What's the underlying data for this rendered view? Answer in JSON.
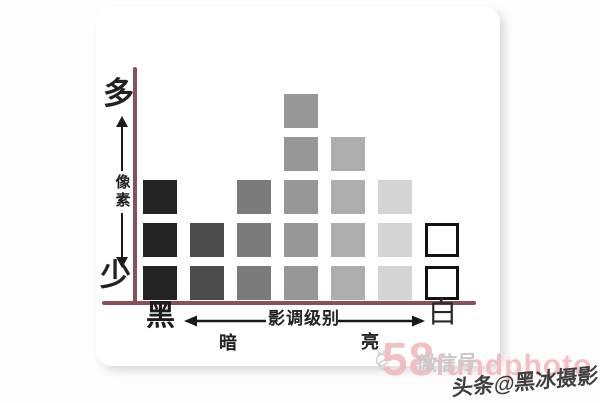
{
  "page": {
    "background": "#fdfdfd",
    "card_background": "#ffffff"
  },
  "axes": {
    "color": "#8b4f5a",
    "arrow_color": "#1a1a1a",
    "y_axis": {
      "top_label": "多",
      "axis_label": "像素",
      "bottom_label": "少"
    },
    "x_axis": {
      "left_label": "黑",
      "center_label": "影调级别",
      "right_label": "白",
      "sub_left_label": "暗",
      "sub_right_label": "亮"
    }
  },
  "chart_data": {
    "type": "bar",
    "x_label": "影调级别",
    "y_label": "像素",
    "x_min_label": "黑",
    "x_max_label": "白",
    "y_min_label": "少",
    "y_max_label": "多",
    "categories": [
      1,
      2,
      3,
      4,
      5,
      6,
      7
    ],
    "values": [
      3,
      2,
      3,
      5,
      4,
      3,
      2
    ],
    "bar_colors": [
      "#232323",
      "#4b4b4b",
      "#7b7b7b",
      "#979797",
      "#aeaeae",
      "#d4d4d4",
      "#ffffff"
    ],
    "white_bar_border_color": "#121212",
    "grid": false,
    "legend": "none",
    "note_sub_left": "暗",
    "note_sub_right": "亮"
  },
  "watermark": {
    "pink_big": "58",
    "pink_small": "fundphoto",
    "pink_color": "#f3b9bc",
    "wechat_label": "微信号",
    "wechat_color": "#cacaca",
    "credit": "头条@黑冰摄影",
    "credit_color": "#3f3f3f"
  }
}
